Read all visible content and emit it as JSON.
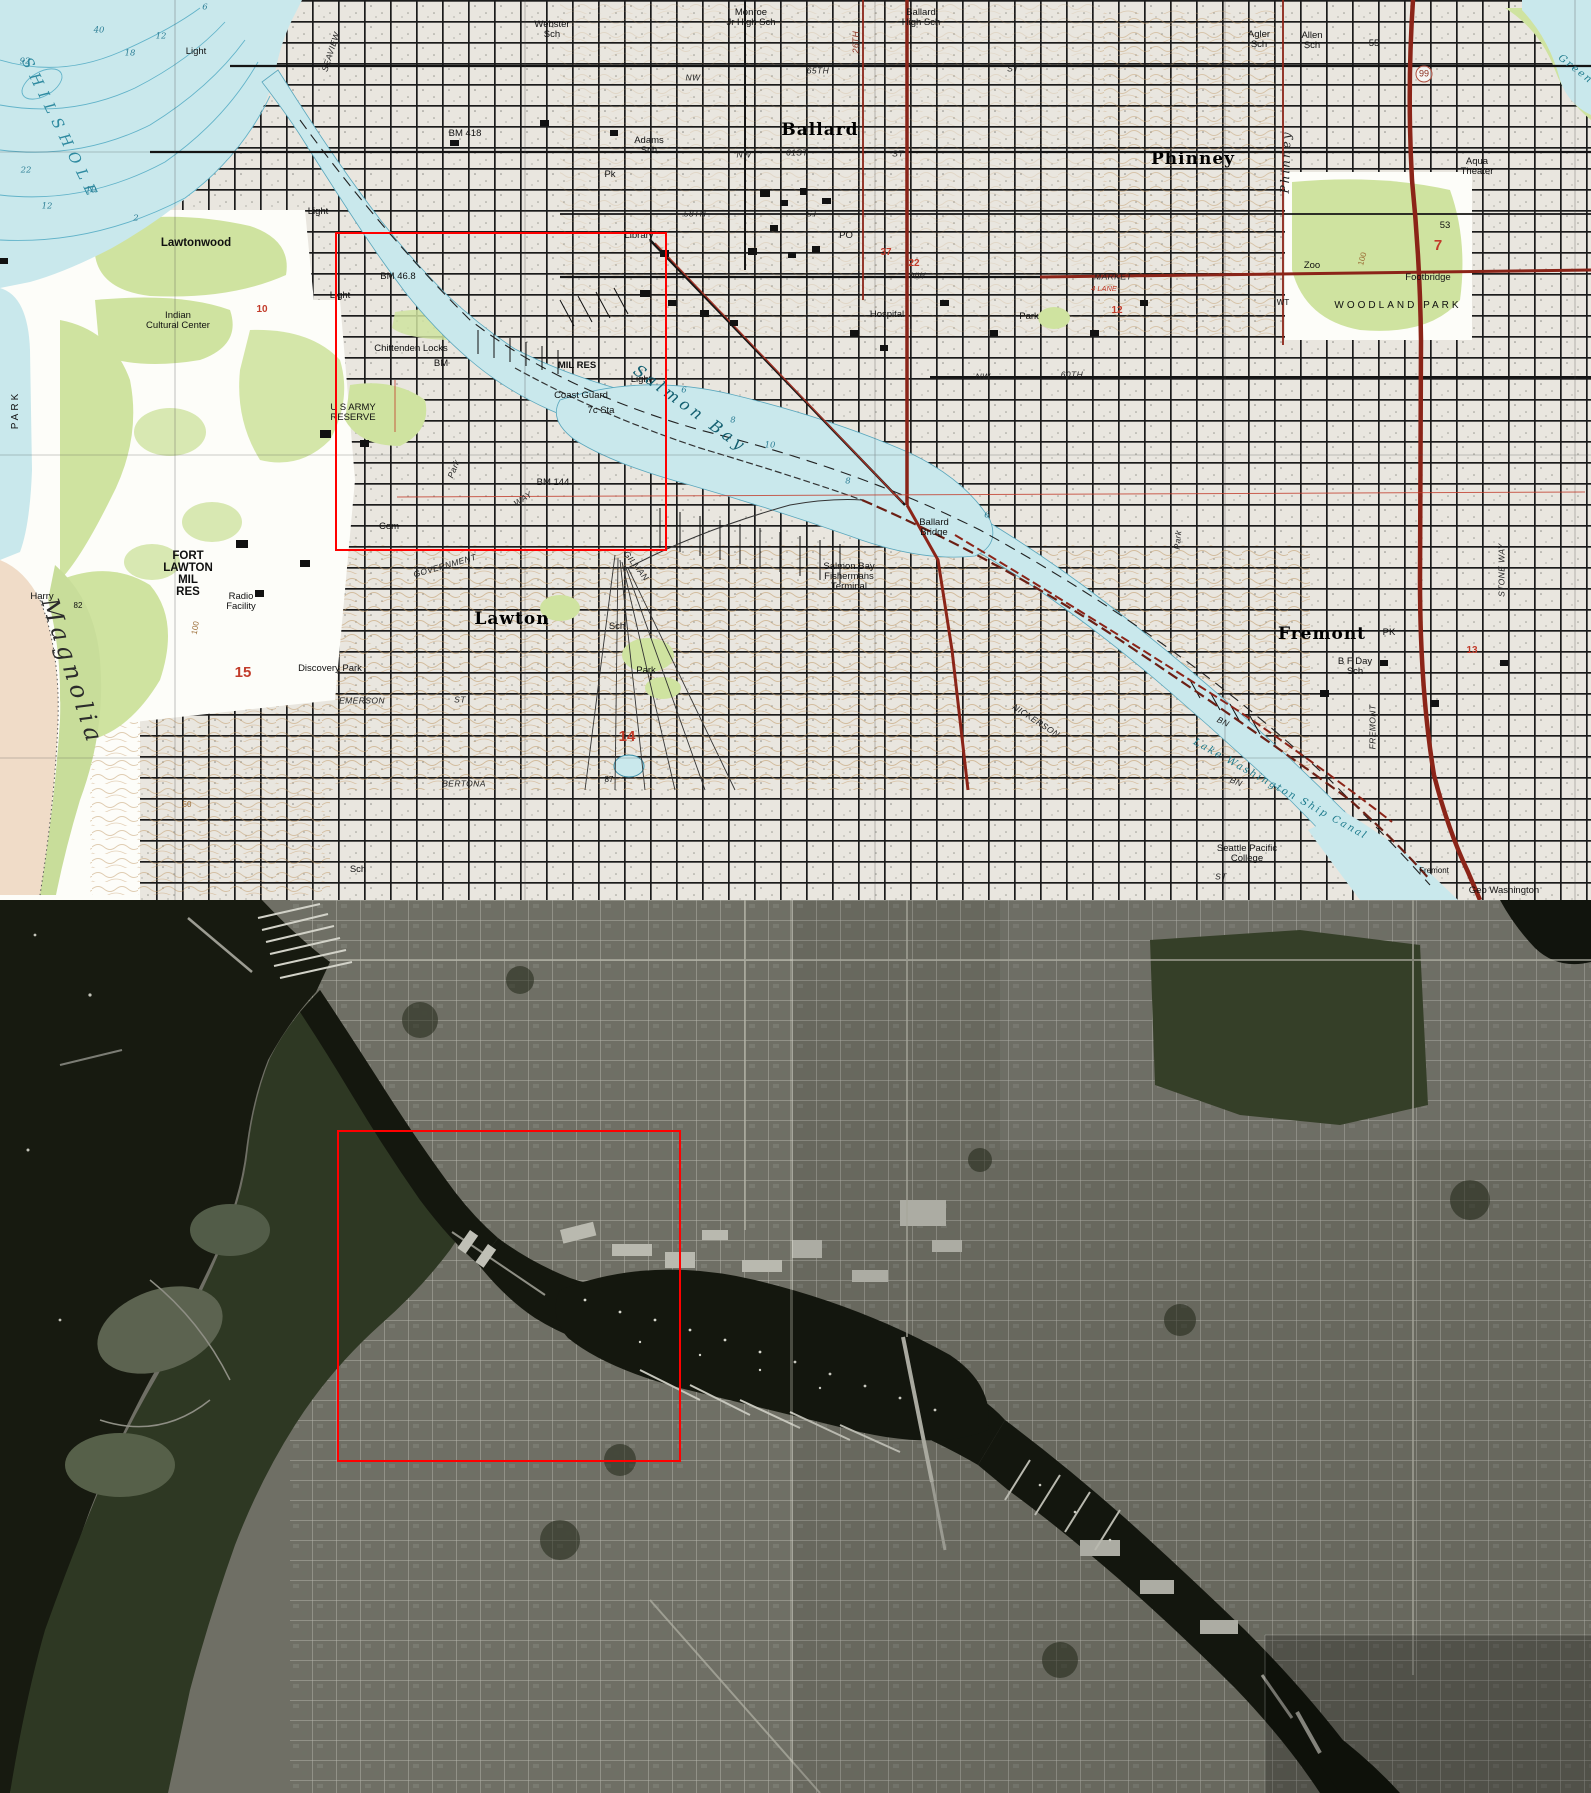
{
  "image_meta": {
    "description_labels_only": true,
    "panel_split_y": 900
  },
  "highlight": {
    "color": "#ff0000",
    "topo_rect": {
      "x": 335,
      "y": 232,
      "w": 332,
      "h": 319
    },
    "aerial_rect": {
      "x": 337,
      "y": 1130,
      "w": 344,
      "h": 332
    }
  },
  "colors": {
    "topo_water": "#c9e8ec",
    "topo_water_line": "#5aa7bd",
    "topo_urban_fill": "#e9e6df",
    "topo_green": "#cfe3a0",
    "topo_tideflat": "#f0dcc8",
    "topo_contour": "#c09a68",
    "topo_highway_red": "#8b2418",
    "aerial_base": "#6f6f65",
    "aerial_water": "#14170e",
    "aerial_forest": "#2e3823",
    "highlight_red": "#ff0000"
  },
  "topo": {
    "labels": [
      {
        "t": "Light",
        "x": 196,
        "y": 52
      },
      {
        "t": "SEAVIEW",
        "x": 331,
        "y": 52,
        "c": "street",
        "r": -72
      },
      {
        "t": "Webster\nSch",
        "x": 552,
        "y": 30
      },
      {
        "t": "Monroe\nJr High Sch",
        "x": 751,
        "y": 18
      },
      {
        "t": "Ballard\nHigh Sch",
        "x": 921,
        "y": 18
      },
      {
        "t": "Agler\nSch",
        "x": 1259,
        "y": 40
      },
      {
        "t": "Allen\nSch",
        "x": 1312,
        "y": 41
      },
      {
        "t": "BM 418",
        "x": 465,
        "y": 134
      },
      {
        "t": "Adams\nSch",
        "x": 649,
        "y": 146
      },
      {
        "t": "Pk",
        "x": 610,
        "y": 175
      },
      {
        "t": "Ballard",
        "x": 820,
        "y": 131,
        "c": "big"
      },
      {
        "t": "NW",
        "x": 693,
        "y": 78,
        "c": "street"
      },
      {
        "t": "65TH",
        "x": 818,
        "y": 71,
        "c": "street"
      },
      {
        "t": "ST",
        "x": 1013,
        "y": 69,
        "c": "street"
      },
      {
        "t": "26TH",
        "x": 856,
        "y": 42,
        "c": "street-red",
        "r": -90
      },
      {
        "t": "NW",
        "x": 744,
        "y": 155,
        "c": "street"
      },
      {
        "t": "61ST",
        "x": 797,
        "y": 153,
        "c": "street"
      },
      {
        "t": "ST",
        "x": 898,
        "y": 154,
        "c": "street"
      },
      {
        "t": "58TH",
        "x": 695,
        "y": 214,
        "c": "street"
      },
      {
        "t": "ST",
        "x": 812,
        "y": 214,
        "c": "street"
      },
      {
        "t": "PO",
        "x": 846,
        "y": 236
      },
      {
        "t": "Library",
        "x": 639,
        "y": 236
      },
      {
        "t": "37",
        "x": 886,
        "y": 253,
        "c": "rednum"
      },
      {
        "t": "22",
        "x": 914,
        "y": 264,
        "c": "rednum"
      },
      {
        "t": "Hospital",
        "x": 887,
        "y": 315
      },
      {
        "t": "Park",
        "x": 1029,
        "y": 317
      },
      {
        "t": "NW",
        "x": 918,
        "y": 276,
        "c": "street"
      },
      {
        "t": "MARKET",
        "x": 1113,
        "y": 277,
        "c": "street"
      },
      {
        "t": "4 LANE",
        "x": 1104,
        "y": 289,
        "c": "redsm"
      },
      {
        "t": "NW",
        "x": 983,
        "y": 377,
        "c": "street"
      },
      {
        "t": "60TH",
        "x": 1072,
        "y": 375,
        "c": "street"
      },
      {
        "t": "Phinney",
        "x": 1193,
        "y": 160,
        "c": "big"
      },
      {
        "t": "Phinney",
        "x": 1286,
        "y": 162,
        "c": "bigitalic",
        "r": -88
      },
      {
        "t": "99",
        "x": 1424,
        "y": 74,
        "c": "shield"
      },
      {
        "t": "Green",
        "x": 1575,
        "y": 70,
        "c": "watermed",
        "r": 38
      },
      {
        "t": "Aqua\nTheater",
        "x": 1477,
        "y": 167
      },
      {
        "t": "53",
        "x": 1445,
        "y": 226
      },
      {
        "t": "55",
        "x": 1374,
        "y": 44
      },
      {
        "t": "Zoo",
        "x": 1312,
        "y": 266
      },
      {
        "t": "WT",
        "x": 1283,
        "y": 303,
        "c": "sm"
      },
      {
        "t": "Footbridge",
        "x": 1428,
        "y": 278
      },
      {
        "t": "WOODLAND PARK",
        "x": 1398,
        "y": 306,
        "c": "spread"
      },
      {
        "t": "7",
        "x": 1438,
        "y": 246,
        "c": "redbig"
      },
      {
        "t": "100",
        "x": 1363,
        "y": 259,
        "c": "brown",
        "r": -75
      },
      {
        "t": "PARK",
        "x": 16,
        "y": 410,
        "c": "spread",
        "r": -90
      },
      {
        "t": "Lawtonwood",
        "x": 196,
        "y": 243,
        "c": "med"
      },
      {
        "t": "Indian\nCultural Center",
        "x": 178,
        "y": 321
      },
      {
        "t": "Light",
        "x": 318,
        "y": 212
      },
      {
        "t": "Light",
        "x": 340,
        "y": 296
      },
      {
        "t": "Light",
        "x": 641,
        "y": 380
      },
      {
        "t": "BM 46.8",
        "x": 398,
        "y": 277
      },
      {
        "t": "Chittenden Locks",
        "x": 411,
        "y": 349
      },
      {
        "t": "BM",
        "x": 441,
        "y": 364
      },
      {
        "t": "MIL RES",
        "x": 577,
        "y": 366,
        "c": "bold"
      },
      {
        "t": "Coast Guard",
        "x": 581,
        "y": 396
      },
      {
        "t": "7c Sta",
        "x": 601,
        "y": 411
      },
      {
        "t": "U S ARMY\nRESERVE",
        "x": 353,
        "y": 413
      },
      {
        "t": "Salmon Bay",
        "x": 690,
        "y": 409,
        "c": "waterbig",
        "r": 36
      },
      {
        "t": "Cem",
        "x": 389,
        "y": 527
      },
      {
        "t": "Park",
        "x": 454,
        "y": 469,
        "c": "street",
        "r": -68
      },
      {
        "t": "BM 144",
        "x": 553,
        "y": 483
      },
      {
        "t": "WAY",
        "x": 523,
        "y": 499,
        "c": "street",
        "r": -33
      },
      {
        "t": "GOVERNMENT",
        "x": 445,
        "y": 566,
        "c": "street",
        "r": -16
      },
      {
        "t": "FORT\nLAWTON\nMIL\nRES",
        "x": 188,
        "y": 574,
        "c": "med"
      },
      {
        "t": "Radio\nFacility",
        "x": 241,
        "y": 602
      },
      {
        "t": "Harry",
        "x": 42,
        "y": 597
      },
      {
        "t": "82",
        "x": 78,
        "y": 606,
        "c": "sm"
      },
      {
        "t": "100",
        "x": 196,
        "y": 628,
        "c": "brown",
        "r": -80
      },
      {
        "t": "Magnolia",
        "x": 72,
        "y": 672,
        "c": "landcursive",
        "r": 72
      },
      {
        "t": "15",
        "x": 243,
        "y": 673,
        "c": "redbig"
      },
      {
        "t": "Discovery Park",
        "x": 330,
        "y": 669
      },
      {
        "t": "EMERSON",
        "x": 362,
        "y": 701,
        "c": "street"
      },
      {
        "t": "ST",
        "x": 460,
        "y": 700,
        "c": "street"
      },
      {
        "t": "Lawton",
        "x": 512,
        "y": 620,
        "c": "big"
      },
      {
        "t": "Sch",
        "x": 617,
        "y": 627
      },
      {
        "t": "Park",
        "x": 646,
        "y": 671
      },
      {
        "t": "14",
        "x": 627,
        "y": 737,
        "c": "redbig"
      },
      {
        "t": "87",
        "x": 609,
        "y": 780,
        "c": "sm"
      },
      {
        "t": "BERTONA",
        "x": 464,
        "y": 784,
        "c": "street"
      },
      {
        "t": "GILMAN",
        "x": 636,
        "y": 566,
        "c": "street",
        "r": 52
      },
      {
        "t": "NICKERSON",
        "x": 1036,
        "y": 721,
        "c": "street",
        "r": 33
      },
      {
        "t": "BN",
        "x": 1223,
        "y": 722,
        "c": "street",
        "r": 25
      },
      {
        "t": "BN",
        "x": 1236,
        "y": 782,
        "c": "street",
        "r": 22
      },
      {
        "t": "Lake Washington Ship Canal",
        "x": 1280,
        "y": 790,
        "c": "watermed",
        "r": 29
      },
      {
        "t": "Seattle Pacific\nCollege",
        "x": 1247,
        "y": 854
      },
      {
        "t": "ST",
        "x": 1221,
        "y": 877,
        "c": "street"
      },
      {
        "t": "Fremont",
        "x": 1434,
        "y": 871,
        "c": "sm"
      },
      {
        "t": "Geo Washington",
        "x": 1504,
        "y": 891
      },
      {
        "t": "Fremont",
        "x": 1322,
        "y": 635,
        "c": "big"
      },
      {
        "t": "PK",
        "x": 1389,
        "y": 633
      },
      {
        "t": "B F Day\nSch",
        "x": 1355,
        "y": 667
      },
      {
        "t": "FREMONT",
        "x": 1373,
        "y": 727,
        "c": "street",
        "r": -90
      },
      {
        "t": "STONE WAY",
        "x": 1502,
        "y": 570,
        "c": "street",
        "r": -90
      },
      {
        "t": "Park",
        "x": 1178,
        "y": 540,
        "c": "street",
        "r": -85
      },
      {
        "t": "13",
        "x": 1472,
        "y": 651,
        "c": "rednum"
      },
      {
        "t": "12",
        "x": 1117,
        "y": 311,
        "c": "rednum"
      },
      {
        "t": "10",
        "x": 262,
        "y": 310,
        "c": "rednum"
      },
      {
        "t": "Sch",
        "x": 358,
        "y": 870
      },
      {
        "t": "50",
        "x": 187,
        "y": 805,
        "c": "brown"
      },
      {
        "t": "SHILSHOLE",
        "x": 60,
        "y": 130,
        "c": "waterbig2",
        "r": 64
      },
      {
        "t": "Ballard\nBridge",
        "x": 934,
        "y": 528
      },
      {
        "t": "Salmon Bay\nFishermans\nTerminal",
        "x": 849,
        "y": 577
      },
      {
        "t": "40",
        "x": 99,
        "y": 31,
        "c": "depth"
      },
      {
        "t": "92",
        "x": 25,
        "y": 62,
        "c": "depth"
      },
      {
        "t": "18",
        "x": 130,
        "y": 54,
        "c": "depth"
      },
      {
        "t": "12",
        "x": 161,
        "y": 37,
        "c": "depth"
      },
      {
        "t": "22",
        "x": 26,
        "y": 171,
        "c": "depth"
      },
      {
        "t": "10",
        "x": 91,
        "y": 191,
        "c": "depth"
      },
      {
        "t": "12",
        "x": 47,
        "y": 207,
        "c": "depth"
      },
      {
        "t": "2",
        "x": 136,
        "y": 219,
        "c": "depth"
      },
      {
        "t": "6",
        "x": 205,
        "y": 8,
        "c": "depth"
      },
      {
        "t": "6",
        "x": 684,
        "y": 391,
        "c": "depth"
      },
      {
        "t": "8",
        "x": 733,
        "y": 421,
        "c": "depth"
      },
      {
        "t": "10",
        "x": 770,
        "y": 446,
        "c": "depth"
      },
      {
        "t": "8",
        "x": 848,
        "y": 482,
        "c": "depth"
      },
      {
        "t": "6",
        "x": 987,
        "y": 516,
        "c": "depth"
      }
    ]
  },
  "aerial": {
    "labels": []
  }
}
